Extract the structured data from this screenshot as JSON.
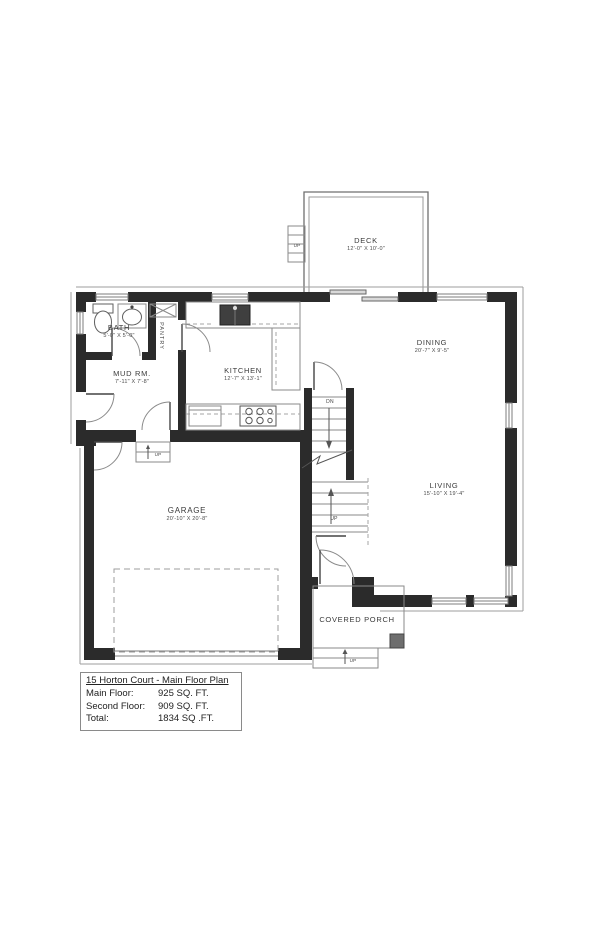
{
  "plan": {
    "rooms": {
      "deck": {
        "name": "DECK",
        "dims": "12'-0\" X 10'-0\""
      },
      "dining": {
        "name": "DINING",
        "dims": "20'-7\" X 9'-5\""
      },
      "kitchen": {
        "name": "KITCHEN",
        "dims": "12'-7\" X 13'-1\""
      },
      "bath": {
        "name": "BATH",
        "dims": "5'-0\" X 5'-0\""
      },
      "pantry": {
        "name": "PANTRY"
      },
      "mud_room": {
        "name": "MUD RM.",
        "dims": "7'-11\" X 7'-8\""
      },
      "garage": {
        "name": "GARAGE",
        "dims": "20'-10\" X 20'-8\""
      },
      "living": {
        "name": "LIVING",
        "dims": "15'-10\" X 19'-4\""
      },
      "covered_porch": {
        "name": "COVERED PORCH"
      }
    },
    "stairs": {
      "down_label": "DN",
      "up_label": "UP",
      "deck_up_label": "UP",
      "porch_up_label": "UP",
      "garage_up_label": "UP"
    },
    "colors": {
      "wall": "#2b2b2b",
      "thin_line": "#8a8a8a",
      "text": "#3a3a3a"
    }
  },
  "title_block": {
    "title": "15 Horton Court - Main Floor Plan",
    "rows": [
      {
        "label": "Main Floor:",
        "value": "925 SQ. FT."
      },
      {
        "label": "Second Floor:",
        "value": "909 SQ. FT."
      },
      {
        "label": "Total:",
        "value": "1834 SQ .FT."
      }
    ]
  }
}
